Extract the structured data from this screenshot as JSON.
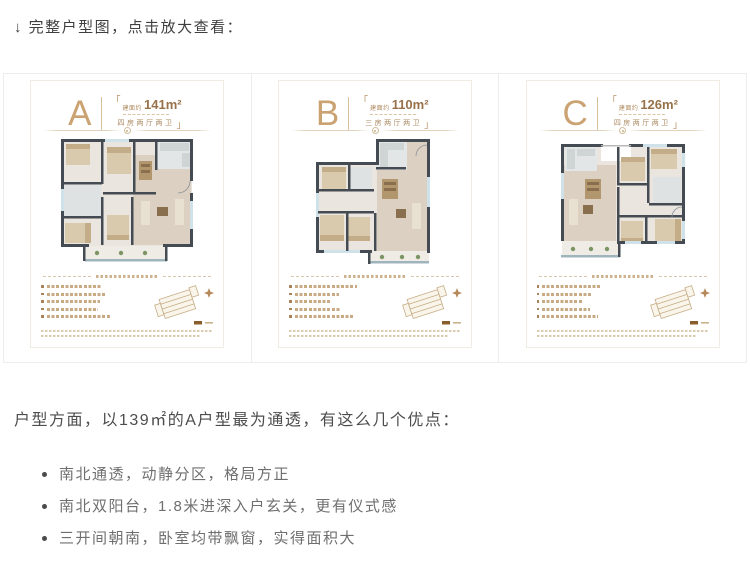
{
  "header": {
    "note": "↓ 完整户型图，点击放大查看："
  },
  "cards": [
    {
      "letter": "A",
      "quote_open": "「",
      "area_prefix": "建面约",
      "area": "141m²",
      "rooms": "四房两厅两卫",
      "quote_close": "」"
    },
    {
      "letter": "B",
      "quote_open": "「",
      "area_prefix": "建面约",
      "area": "110m²",
      "rooms": "三房两厅两卫",
      "quote_close": "」"
    },
    {
      "letter": "C",
      "quote_open": "「",
      "area_prefix": "建面约",
      "area": "126m²",
      "rooms": "四房两厅两卫",
      "quote_close": "」"
    }
  ],
  "article": {
    "intro": "户型方面，以139㎡的A户型最为通透，有这么几个优点：",
    "bullets": [
      "南北通透，动静分区，格局方正",
      "南北双阳台，1.8米进深入户玄关，更有仪式感",
      "三开间朝南，卧室均带飘窗，实得面积大"
    ]
  },
  "colors": {
    "accent_brown": "#b98d62",
    "wall": "#454b52",
    "window_blue": "#cfe1e9",
    "floor_light": "#eae6df",
    "floor_tan": "#dbd0c1",
    "text_dark": "#4d4d4d",
    "text_muted": "#6f6f6f"
  }
}
